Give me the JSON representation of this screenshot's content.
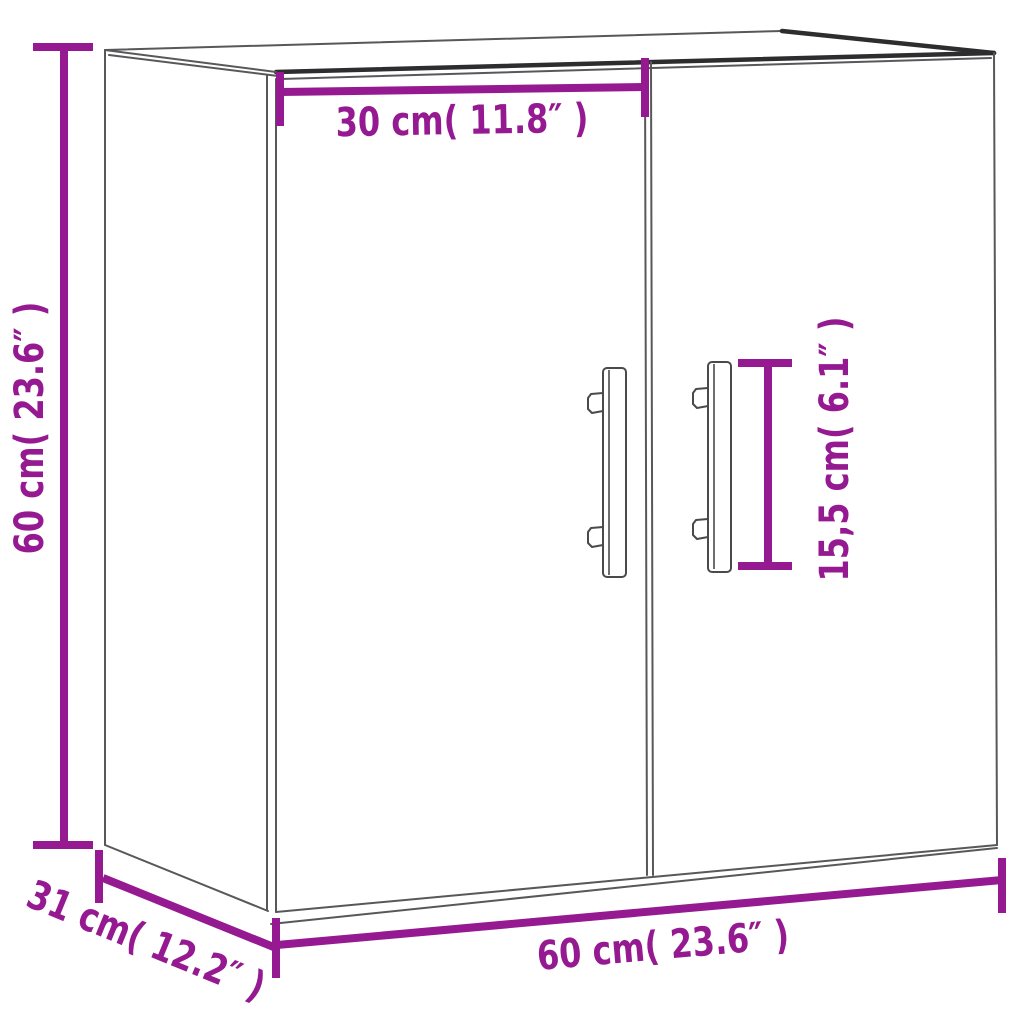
{
  "meta": {
    "title": "Wall cabinet dimension diagram",
    "product": "wall cabinet with two doors and bar handles",
    "view": "three-quarter line drawing"
  },
  "colors": {
    "background": "#ffffff",
    "dimension_accent": "#951a91",
    "outline_thin": "#58585a",
    "outline_thick": "#2d2d2f"
  },
  "dimensions": {
    "door_width": {
      "label": "30 cm( 11.8″ )",
      "value_cm": "30",
      "value_in": "11.8",
      "position": "top",
      "orientation": "horizontal"
    },
    "height": {
      "label": "60 cm( 23.6″ )",
      "value_cm": "60",
      "value_in": "23.6",
      "position": "left",
      "orientation": "vertical"
    },
    "handle_length": {
      "label": "15,5 cm( 6.1″ )",
      "value_cm": "15,5",
      "value_in": "6.1",
      "position": "right-of-handle",
      "orientation": "vertical"
    },
    "width": {
      "label": "60 cm( 23.6″ )",
      "value_cm": "60",
      "value_in": "23.6",
      "position": "bottom",
      "orientation": "horizontal"
    },
    "depth": {
      "label": "31 cm( 12.2″ )",
      "value_cm": "31",
      "value_in": "12.2",
      "position": "bottom-left",
      "orientation": "diagonal"
    }
  }
}
